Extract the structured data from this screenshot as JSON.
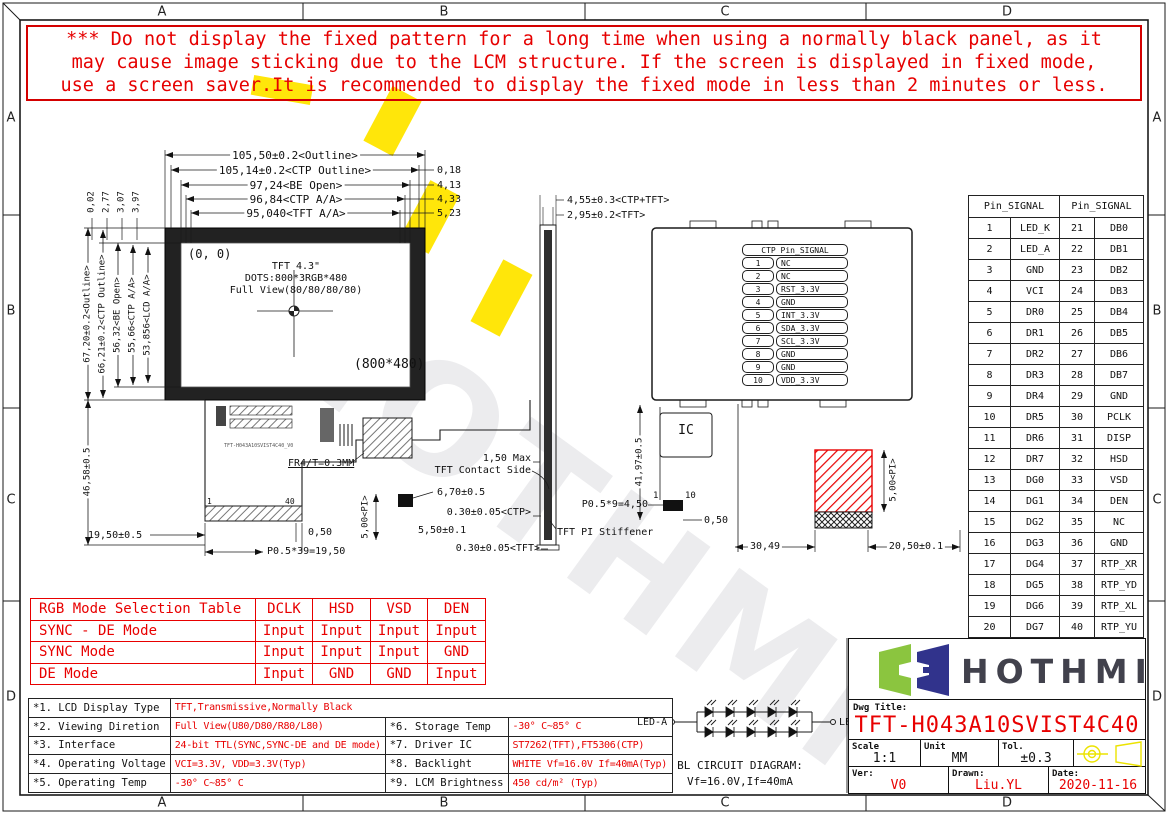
{
  "zone_labels": {
    "cols": [
      "A",
      "B",
      "C",
      "D"
    ],
    "rows": [
      "A",
      "B",
      "C",
      "D"
    ]
  },
  "warning": {
    "lines": [
      "*** Do not display the fixed pattern for a long time when using a normally black panel, as it",
      "may cause image sticking due to the LCM structure. If the screen is displayed in fixed mode,",
      "use a screen saver.It is recommended to display the fixed mode in less than 2 minutes or less."
    ]
  },
  "front_view": {
    "origin_label": "(0, 0)",
    "title": "TFT 4.3\"",
    "dots": "DOTS:800*3RGB*480",
    "view": "Full View(80/80/80/80)",
    "resolution": "(800*480)"
  },
  "dims": {
    "outline_w": "105,50±0.2<Outline>",
    "ctp_outline_w": "105,14±0.2<CTP Outline>",
    "be_open_w": "97,24<BE Open>",
    "ctp_aa_w": "96,84<CTP A/A>",
    "tft_aa_w": "95,040<TFT A/A>",
    "off1": "0,18",
    "off2": "4,13",
    "off3": "4,33",
    "off4": "5,23",
    "side_total": "4,55±0.3<CTP+TFT>",
    "side_tft": "2,95±0.2<TFT>",
    "top_off1": "0,02",
    "top_off2": "2,77",
    "top_off3": "3,07",
    "top_off4": "3,97",
    "outline_h": "67,20±0.2<Outline>",
    "ctp_outline_h": "66,21±0.2<CTP Outline>",
    "be_open_h": "56,32<BE Open>",
    "ctp_aa_h": "55,66<CTP A/A>",
    "lcd_aa_h": "53,856<LCD A/A>",
    "fpc_h": "46,58±0.5",
    "fpc_w": "19,50±0.5",
    "fr4": "FR4/T=0.3MM",
    "conn_pitch": "P0.5*39=19,50",
    "conn_off": "0,50",
    "sq_h": "6,70±0.5",
    "pi_h1": "5,00<PI>",
    "stiff_w": "5,50±0.1",
    "ctp_t": "0.30±0.05<CTP>",
    "tft_t": "0.30±0.05<TFT>",
    "max_t": "1,50 Max",
    "contact_side": "TFT Contact Side",
    "pi_stiffener": "TFT PI Stiffener",
    "ic": "IC",
    "back_h": "41,97±0.5",
    "back_pitch": "P0.5*9=4,50",
    "back_off": "0,50",
    "back_w1": "30,49",
    "back_w2": "20,50±0.1",
    "pi_h2": "5,00<PI>",
    "pin1": "1",
    "pin40": "40",
    "bpin1": "1",
    "bpin10": "10",
    "fpc_code": "TFT-H043A10SVIST4C40_V0"
  },
  "ctp_table": {
    "header": "CTP Pin_SIGNAL",
    "rows": [
      [
        "1",
        "NC"
      ],
      [
        "2",
        "NC"
      ],
      [
        "3",
        "RST_3.3V"
      ],
      [
        "4",
        "GND"
      ],
      [
        "5",
        "INT_3.3V"
      ],
      [
        "6",
        "SDA_3.3V"
      ],
      [
        "7",
        "SCL_3.3V"
      ],
      [
        "8",
        "GND"
      ],
      [
        "9",
        "GND"
      ],
      [
        "10",
        "VDD_3.3V"
      ]
    ]
  },
  "pin_table": {
    "header1": "Pin_SIGNAL",
    "header2": "Pin_SIGNAL",
    "rows": [
      [
        "1",
        "LED_K",
        "21",
        "DB0"
      ],
      [
        "2",
        "LED_A",
        "22",
        "DB1"
      ],
      [
        "3",
        "GND",
        "23",
        "DB2"
      ],
      [
        "4",
        "VCI",
        "24",
        "DB3"
      ],
      [
        "5",
        "DR0",
        "25",
        "DB4"
      ],
      [
        "6",
        "DR1",
        "26",
        "DB5"
      ],
      [
        "7",
        "DR2",
        "27",
        "DB6"
      ],
      [
        "8",
        "DR3",
        "28",
        "DB7"
      ],
      [
        "9",
        "DR4",
        "29",
        "GND"
      ],
      [
        "10",
        "DR5",
        "30",
        "PCLK"
      ],
      [
        "11",
        "DR6",
        "31",
        "DISP"
      ],
      [
        "12",
        "DR7",
        "32",
        "HSD"
      ],
      [
        "13",
        "DG0",
        "33",
        "VSD"
      ],
      [
        "14",
        "DG1",
        "34",
        "DEN"
      ],
      [
        "15",
        "DG2",
        "35",
        "NC"
      ],
      [
        "16",
        "DG3",
        "36",
        "GND"
      ],
      [
        "17",
        "DG4",
        "37",
        "RTP_XR"
      ],
      [
        "18",
        "DG5",
        "38",
        "RTP_YD"
      ],
      [
        "19",
        "DG6",
        "39",
        "RTP_XL"
      ],
      [
        "20",
        "DG7",
        "40",
        "RTP_YU"
      ]
    ]
  },
  "rgb_table": {
    "header": [
      "RGB Mode Selection Table",
      "DCLK",
      "HSD",
      "VSD",
      "DEN"
    ],
    "rows": [
      [
        "SYNC - DE Mode",
        "Input",
        "Input",
        "Input",
        "Input"
      ],
      [
        "SYNC Mode",
        "Input",
        "Input",
        "Input",
        "GND"
      ],
      [
        "DE Mode",
        "Input",
        "GND",
        "GND",
        "Input"
      ]
    ]
  },
  "spec": {
    "r1": {
      "label": "*1. LCD Display Type",
      "value": "TFT,Transmissive,Normally Black"
    },
    "r2": {
      "label": "*2. Viewing Diretion",
      "value": "Full View(U80/D80/R80/L80)"
    },
    "r3": {
      "label": "*3. Interface",
      "value": "24-bit TTL(SYNC,SYNC-DE and DE mode)"
    },
    "r4": {
      "label": "*4. Operating Voltage",
      "value": "VCI=3.3V, VDD=3.3V(Typ)"
    },
    "r5": {
      "label": "*5. Operating Temp",
      "value": "-30° C~85° C"
    },
    "r6": {
      "label": "*6. Storage Temp",
      "value": "-30° C~85° C"
    },
    "r7": {
      "label": "*7. Driver IC",
      "value": "ST7262(TFT),FT5306(CTP)"
    },
    "r8": {
      "label": "*8. Backlight",
      "value": "WHITE Vf=16.0V If=40mA(Typ)"
    },
    "r9": {
      "label": "*9. LCM Brightness",
      "value": "450 cd/m² (Typ)"
    }
  },
  "bl": {
    "led_a": "LED-A",
    "led_k": "LED-K",
    "title": "BL CIRCUIT DIAGRAM:",
    "subtitle": "Vf=16.0V,If=40mA"
  },
  "title_block": {
    "logo_text": "HOTHMI",
    "dwg_title_label": "Dwg Title:",
    "dwg_title": "TFT-H043A10SVIST4C40",
    "scale_label": "Scale",
    "scale": "1:1",
    "unit_label": "Unit",
    "unit": "MM",
    "tol_label": "Tol.",
    "tol": "±0.3",
    "ver_label": "Ver:",
    "ver": "V0",
    "drawn_label": "Drawn:",
    "drawn": "Liu.YL",
    "date_label": "Date:",
    "date": "2020-11-16"
  },
  "watermark": {
    "text": "HOTHMI"
  },
  "colors": {
    "red": "#e60000",
    "yellow": "#ffe60a",
    "logo_green": "#8bc53f",
    "logo_navy": "#31338c"
  }
}
